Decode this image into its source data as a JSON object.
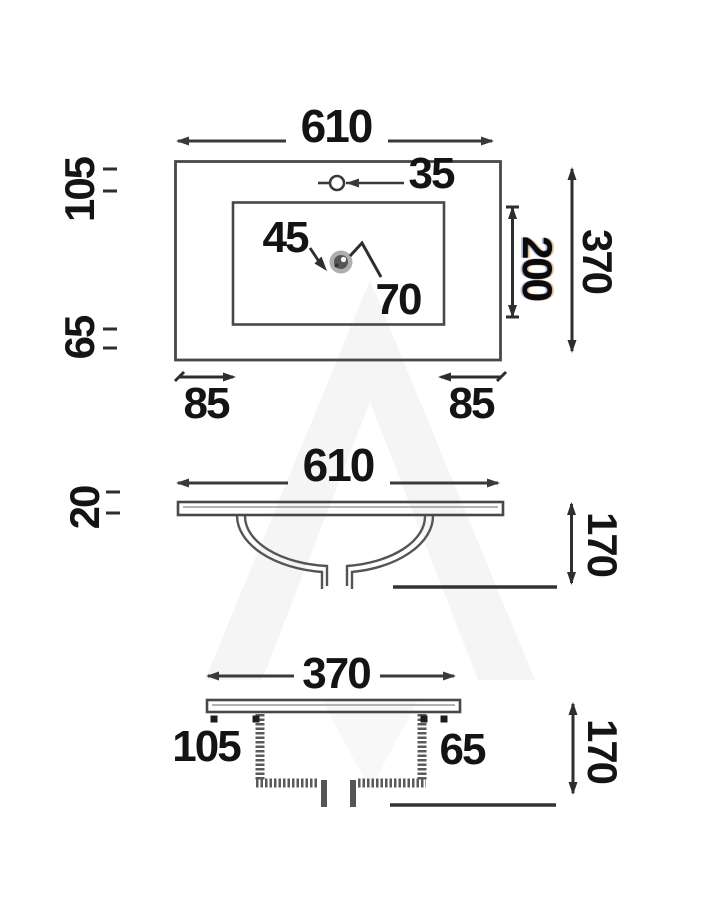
{
  "views": {
    "top": {
      "width": "610",
      "faucet_hole": "35",
      "top_margin": "105",
      "bottom_margin": "65",
      "drain_offset_x": "45",
      "drain_offset_y": "70",
      "bowl_depth": "200",
      "overall_depth": "370",
      "corner_left": "85",
      "corner_right": "85"
    },
    "front": {
      "width": "610",
      "slab_thickness": "20",
      "bowl_height": "170"
    },
    "side": {
      "width": "370",
      "left_margin": "105",
      "right_margin": "65",
      "bowl_height": "170"
    }
  },
  "colors": {
    "line": "#3f3f3f",
    "text": "#141414",
    "bold_dim": "#0a0a0a",
    "background": "#ffffff",
    "watermark": "#efefef"
  }
}
